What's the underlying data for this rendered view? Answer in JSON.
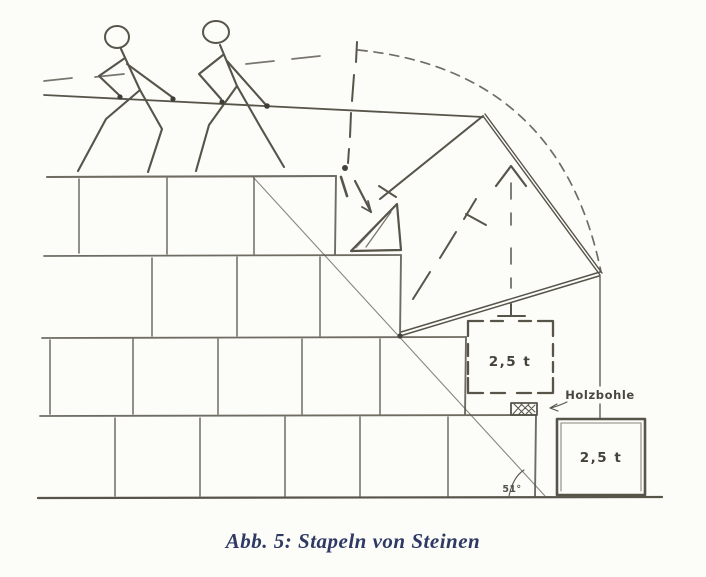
{
  "figure": {
    "caption": "Abb. 5: Stapeln von Steinen",
    "labels": {
      "raised_block_weight": "2,5 t",
      "ground_block_weight": "2,5 t",
      "plank": "Holzbohle",
      "angle": "51°"
    },
    "colors": {
      "ink": "#57544a",
      "caption_text": "#2e3a63",
      "paper": "#fcfcf9"
    }
  }
}
